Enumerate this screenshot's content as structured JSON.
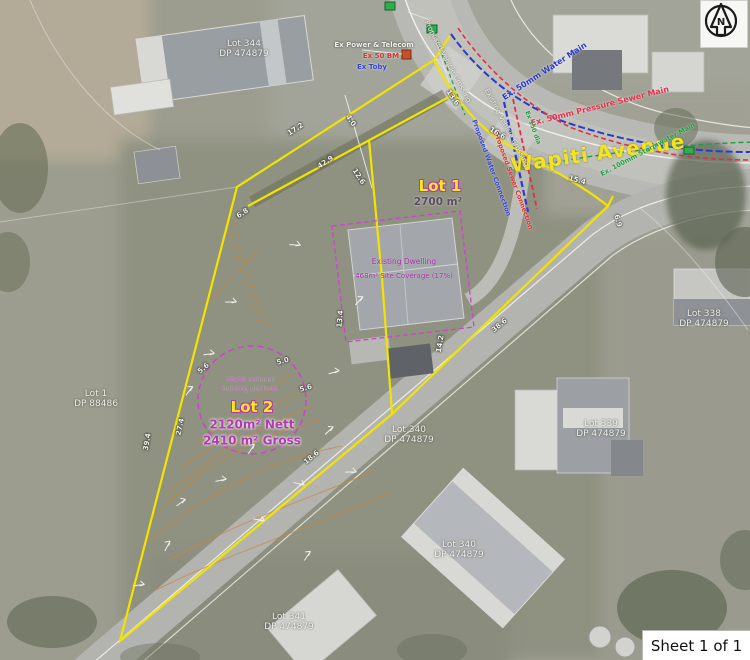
{
  "map": {
    "road_name": "Wapiti Avenue",
    "sheet_label": "Sheet 1 of 1",
    "north_letter": "N"
  },
  "lot1": {
    "name": "Lot 1",
    "area": "2700 m²"
  },
  "lot2": {
    "name": "Lot 2",
    "nett": "2120m² Nett",
    "gross": "2410 m² Gross",
    "platform_line1": "20x30 notional",
    "platform_line2": "building platform"
  },
  "dwelling": {
    "line1": "Existing Dwelling",
    "line2": "468m² Site Coverage (17%)"
  },
  "parcels": [
    {
      "lot": "Lot 344",
      "dp": "DP 474879"
    },
    {
      "lot": "Lot 1",
      "dp": "DP 88486"
    },
    {
      "lot": "Lot 338",
      "dp": "DP 474879"
    },
    {
      "lot": "Lot 339",
      "dp": "DP 474879"
    },
    {
      "lot": "Lot 340",
      "dp": "DP 474879"
    },
    {
      "lot": "Lot 340",
      "dp": "DP 474879"
    },
    {
      "lot": "Lot 341",
      "dp": "DP 474879"
    }
  ],
  "utilities": {
    "power": "Ex Power & Telecom",
    "bm": "Ex 50 BM",
    "toby": "Ex Toby",
    "water_main": "Ex. 50mm Water Main",
    "sewer_main": "Ex. 50mm Pressure Sewer Main",
    "storm_main": "Ex. 100mm Stormwater Main",
    "dia150": "Ex 150 dia",
    "water_conn": "Proposed Water Connection",
    "sewer_conn": "Proposed Sewer Connection",
    "prop_crossing": "Proposed Vehicle Crossing",
    "exist_crossing": "Existing Vehicle Crossing"
  },
  "dimensions": [
    "17.2",
    "4.0",
    "42.9",
    "12.6",
    "6.8",
    "13.6",
    "16.6",
    "15.4",
    "6.9",
    "38.6",
    "13.4",
    "14.2",
    "5.6",
    "5.0",
    "5.6",
    "27.4",
    "39.4",
    "18.6"
  ],
  "colors": {
    "boundary_yellow": "#f2e400",
    "platform_magenta": "#cc44cc",
    "water_blue": "#2a3bcc",
    "sewer_red": "#e03048",
    "storm_green": "#1f9e3f",
    "contour_orange": "#c8883c"
  }
}
